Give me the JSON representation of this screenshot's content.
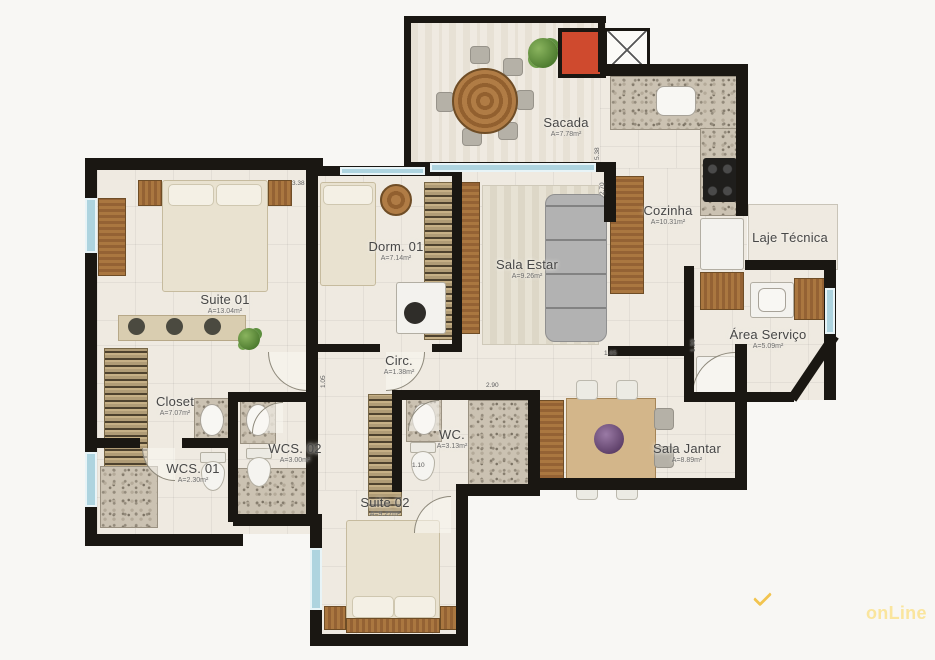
{
  "rooms": [
    {
      "id": "sacada",
      "name": "Sacada",
      "area": "A=7.78m²"
    },
    {
      "id": "cozinha",
      "name": "Cozinha",
      "area": "A=10.31m²"
    },
    {
      "id": "laje-tecnica",
      "name": "Laje Técnica",
      "area": ""
    },
    {
      "id": "area-servico",
      "name": "Área Serviço",
      "area": "A=5.09m²"
    },
    {
      "id": "sala-estar",
      "name": "Sala Estar",
      "area": "A=9.26m²"
    },
    {
      "id": "dorm-01",
      "name": "Dorm. 01",
      "area": "A=7.14m²"
    },
    {
      "id": "suite-01",
      "name": "Suite 01",
      "area": "A=13.04m²"
    },
    {
      "id": "closet",
      "name": "Closet",
      "area": "A=7.07m²"
    },
    {
      "id": "wcs-01",
      "name": "WCS. 01",
      "area": "A=2.30m²"
    },
    {
      "id": "wcs-02",
      "name": "WCS. 02",
      "area": "A=3.00m²"
    },
    {
      "id": "circ",
      "name": "Circ.",
      "area": "A=1.38m²"
    },
    {
      "id": "wc",
      "name": "WC.",
      "area": "A=3.13m²"
    },
    {
      "id": "suite-02",
      "name": "Suite 02",
      "area": "A=9.27m²"
    },
    {
      "id": "sala-jantar",
      "name": "Sala Jantar",
      "area": "A=8.89m²"
    }
  ],
  "dimensions": [
    "5.38",
    "2.70",
    "3.38",
    "1.05",
    "2.90",
    "1.65",
    "1.10",
    "1.30"
  ],
  "watermark": {
    "brand": "onLine",
    "icon": "chevron-down-icon"
  },
  "colors": {
    "wall": "#1a1712",
    "floor": "#efeae1",
    "glass": "#aed4df",
    "shaft_red": "#cf4a2e",
    "watermark_yellow": "#f2c44f"
  }
}
